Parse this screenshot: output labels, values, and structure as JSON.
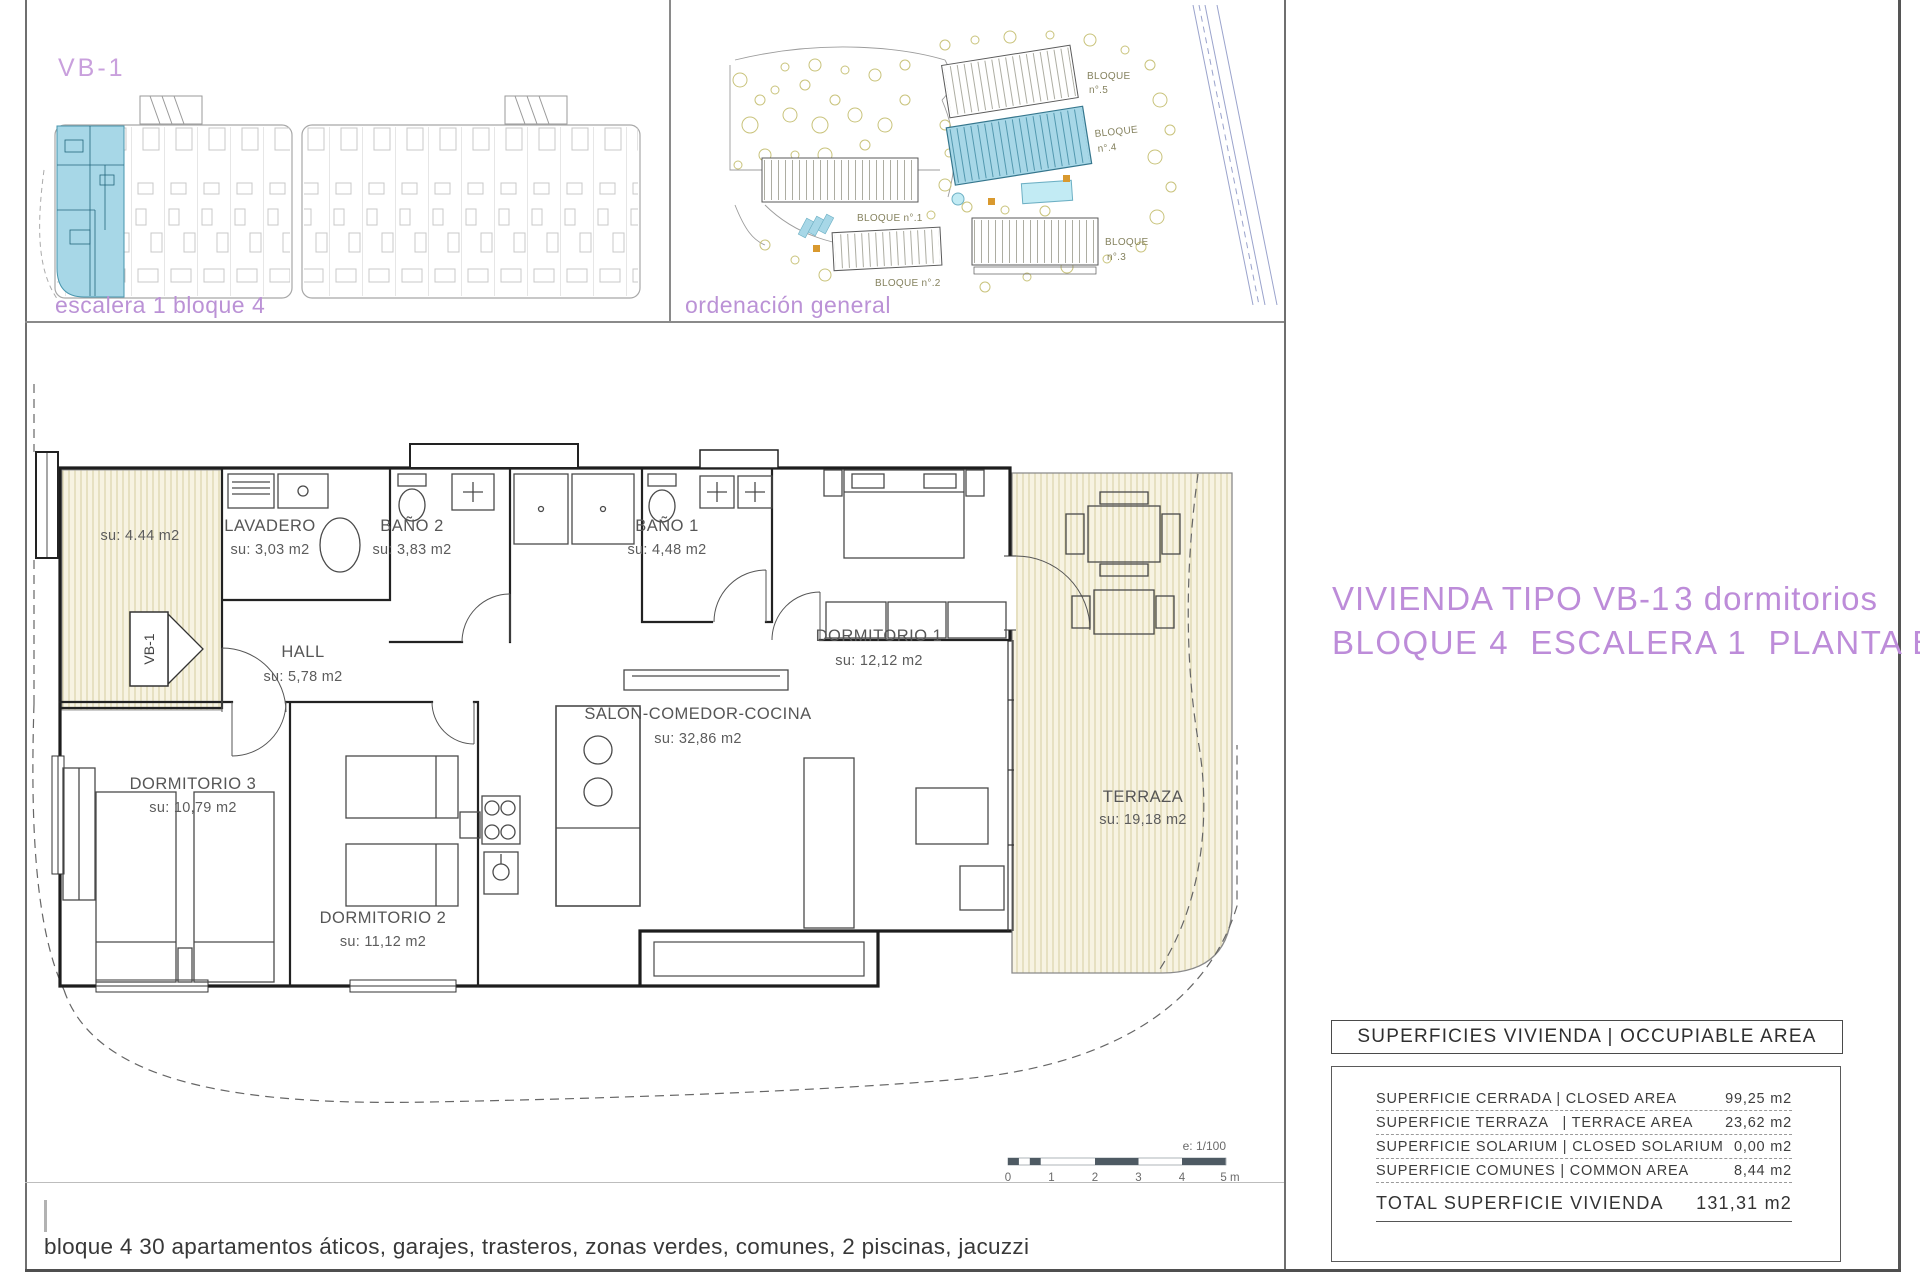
{
  "panels": {
    "unit_key": {
      "label": "VB-1",
      "caption": "escalera 1 bloque 4"
    },
    "site": {
      "caption": "ordenación general",
      "blocks": [
        {
          "top": "BLOQUE",
          "bottom": "n°.5"
        },
        {
          "top": "BLOQUE",
          "bottom": "n°.4"
        },
        {
          "single": "BLOQUE n°.1"
        },
        {
          "single": "BLOQUE n°.2"
        },
        {
          "top": "BLOQUE",
          "bottom": "n°.3"
        }
      ]
    }
  },
  "title": {
    "line1_left": "VIVIENDA TIPO VB-1",
    "line1_right": "3 dormitorios",
    "line2": "BLOQUE 4  ESCALERA 1  PLANTA BAJA"
  },
  "floorplan": {
    "unit_tag": "VB-1",
    "rooms": [
      {
        "name": "",
        "area": "su: 4.44 m2"
      },
      {
        "name": "LAVADERO",
        "area": "su: 3,03 m2"
      },
      {
        "name": "BAÑO 2",
        "area": "su: 3,83 m2"
      },
      {
        "name": "BAÑO 1",
        "area": "su: 4,48 m2"
      },
      {
        "name": "HALL",
        "area": "su: 5,78 m2"
      },
      {
        "name": "DORMITORIO 1",
        "area": "su: 12,12 m2"
      },
      {
        "name": "SALON-COMEDOR-COCINA",
        "area": "su: 32,86 m2"
      },
      {
        "name": "DORMITORIO 3",
        "area": "su: 10,79 m2"
      },
      {
        "name": "DORMITORIO 2",
        "area": "su: 11,12 m2"
      },
      {
        "name": "TERRAZA",
        "area": "su: 19,18 m2"
      }
    ],
    "scale": {
      "ratio": "e: 1/100",
      "ticks": [
        "0",
        "1",
        "2",
        "3",
        "4",
        "5 m"
      ]
    }
  },
  "areas_table": {
    "header": "SUPERFICIES VIVIENDA | OCCUPIABLE AREA",
    "rows": [
      {
        "label": "SUPERFICIE CERRADA | CLOSED AREA",
        "value": "99,25 m2"
      },
      {
        "label": "SUPERFICIE TERRAZA   | TERRACE AREA",
        "value": "23,62 m2"
      },
      {
        "label": "SUPERFICIE SOLARIUM | CLOSED SOLARIUM",
        "value": "0,00 m2"
      },
      {
        "label": "SUPERFICIE COMUNES | COMMON AREA",
        "value": "8,44 m2"
      }
    ],
    "total": {
      "label": "TOTAL SUPERFICIE VIVIENDA",
      "value": "131,31 m2"
    }
  },
  "footer": {
    "note": "bloque 4 30 apartamentos áticos, garajes, trasteros, zonas verdes, comunes, 2 piscinas, jacuzzi"
  },
  "colors": {
    "accent_purple": "#bd8cd9",
    "highlight_blue": "#a7d7e7",
    "hatch_beige": "#f7f3e2",
    "wall_black": "#1d1d1d",
    "pool_blue": "#c2ebf4",
    "tree_olive": "#c9c37b",
    "orange_marker": "#d9992e"
  }
}
